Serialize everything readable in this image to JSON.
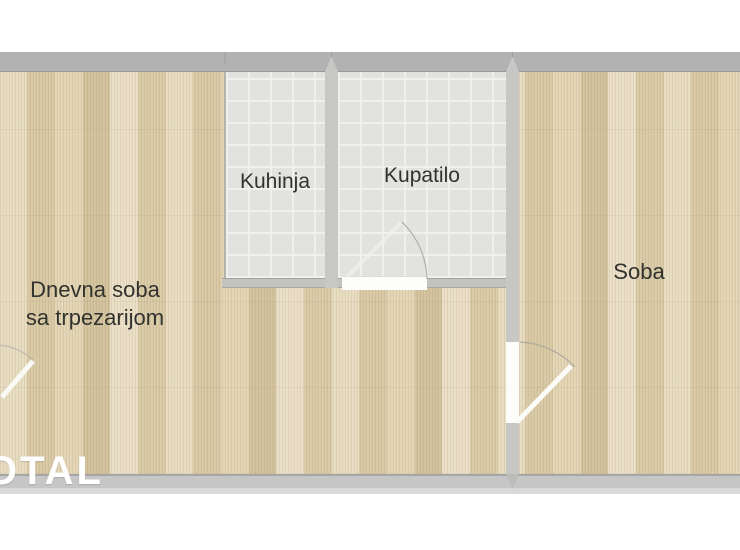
{
  "rooms": {
    "living": {
      "line1": "Dnevna soba",
      "line2": "sa trpezarijom"
    },
    "kitchen": {
      "label": "Kuhinja"
    },
    "bathroom": {
      "label": "Kupatilo"
    },
    "bedroom": {
      "label": "Soba"
    }
  },
  "watermark": {
    "text": "OTAL"
  },
  "colors": {
    "wall-band": "#b2b2b2",
    "wall-light": "#c7c7c5",
    "tile": "#e2e2e0",
    "wood-base": "#decfad",
    "label": "#32322e",
    "wm": "#ffffff"
  }
}
